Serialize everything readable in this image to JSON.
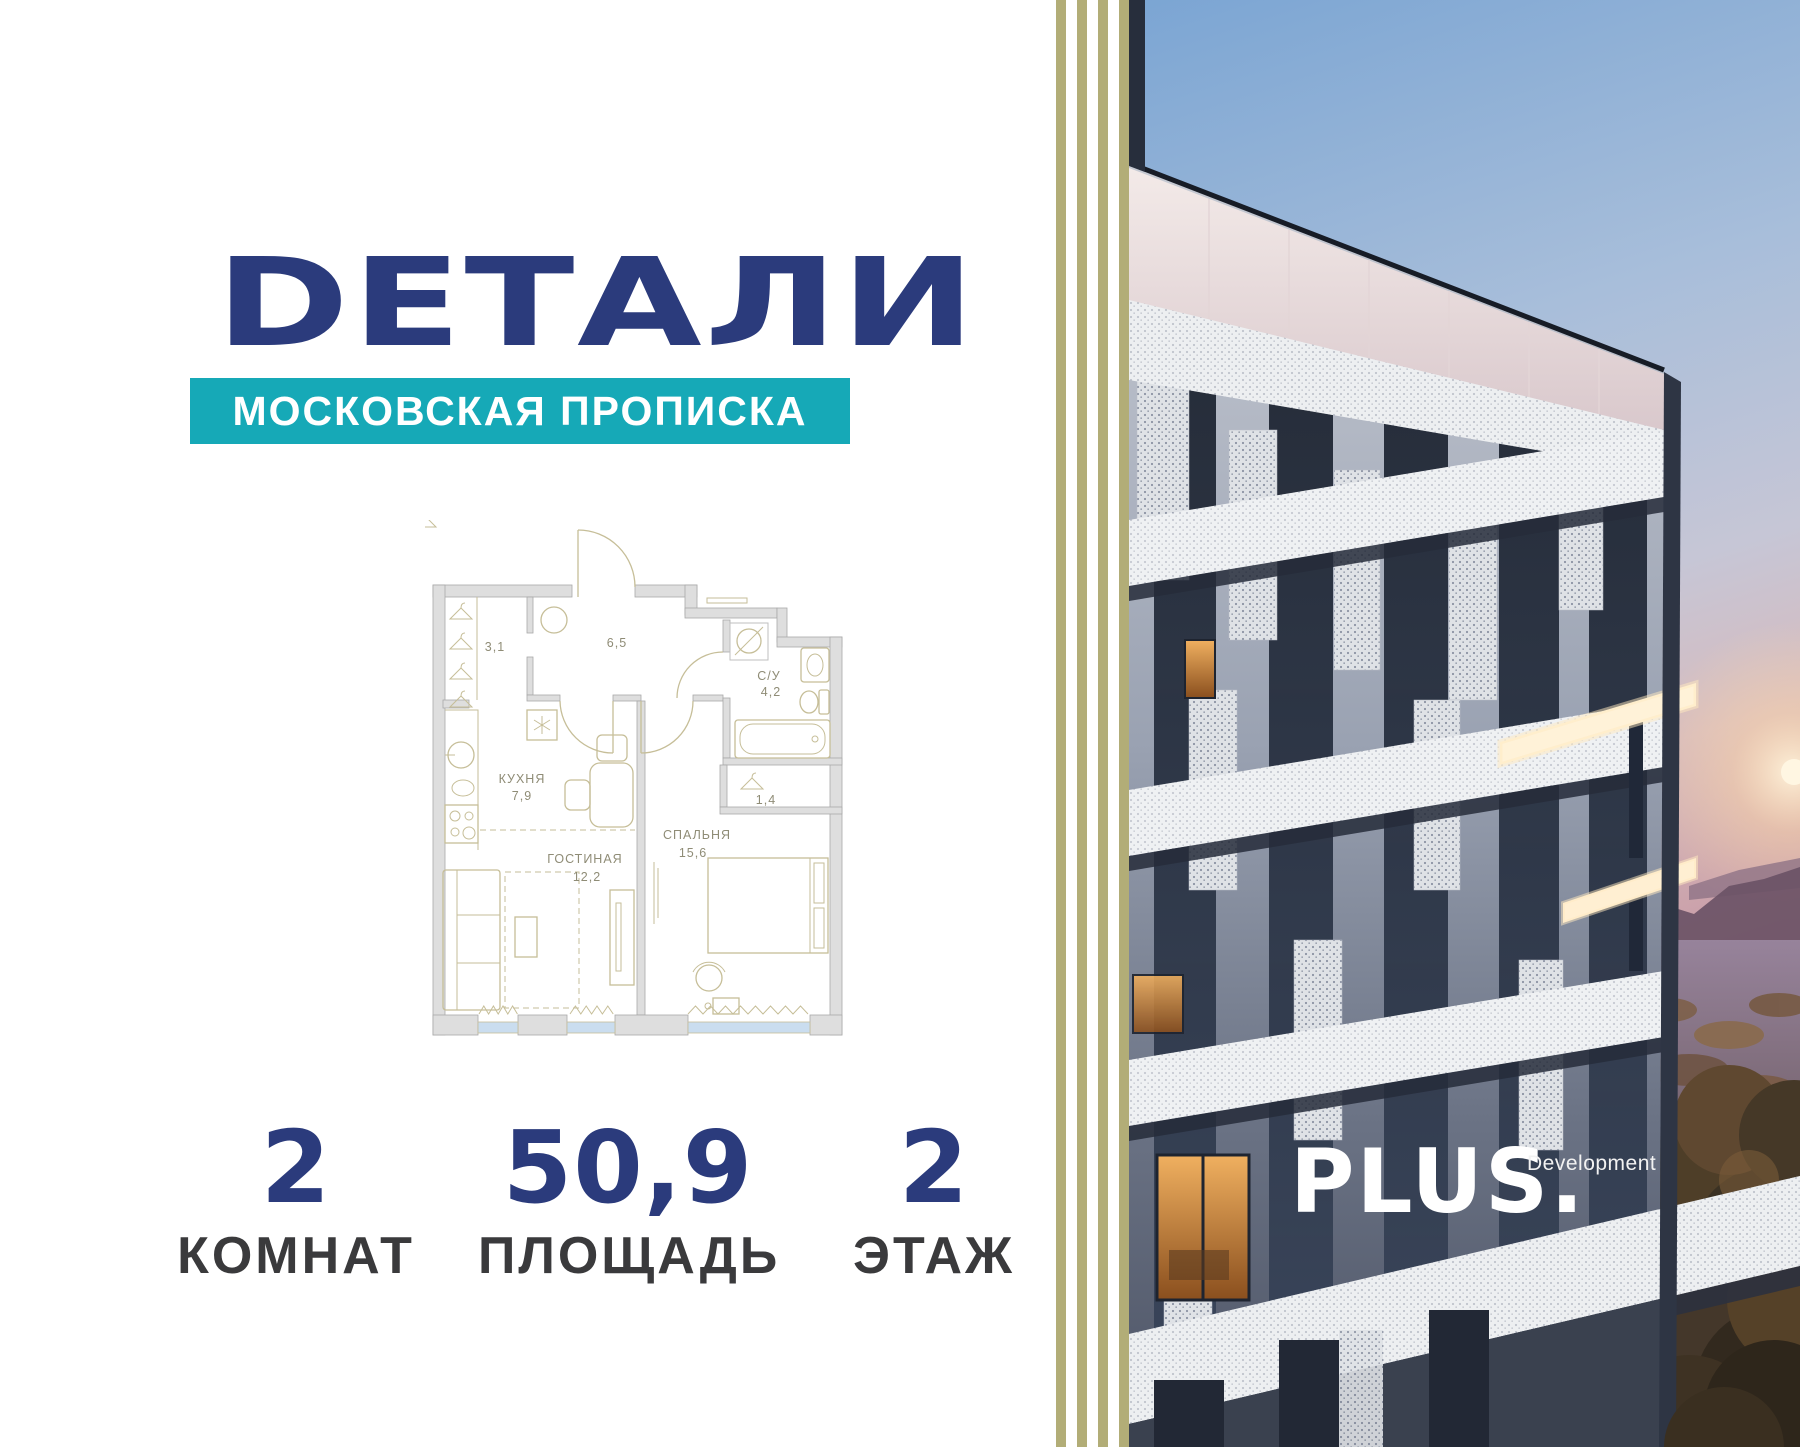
{
  "brand": {
    "logo": "DЕТАЛИ",
    "tagline": "МОСКОВСКАЯ ПРОПИСКА"
  },
  "developer": {
    "name": "PLUS.",
    "descriptor": "Development"
  },
  "floor_plan": {
    "rooms": [
      {
        "name": "",
        "area": "3,1"
      },
      {
        "name": "",
        "area": "6,5"
      },
      {
        "name": "С/У",
        "area": "4,2"
      },
      {
        "name": "КУХНЯ",
        "area": "7,9"
      },
      {
        "name": "",
        "area": "1,4"
      },
      {
        "name": "ГОСТИНАЯ",
        "area": "12,2"
      },
      {
        "name": "СПАЛЬНЯ",
        "area": "15,6"
      }
    ]
  },
  "stats": [
    {
      "value": "2",
      "label": "КОМНАТ"
    },
    {
      "value": "50,9",
      "label": "ПЛОЩАДЬ"
    },
    {
      "value": "2",
      "label": "ЭТАЖ"
    }
  ],
  "colors": {
    "navy": "#2B3B7C",
    "teal": "#16A9B7",
    "stripe_olive": "#B2AD77",
    "plan_line": "#C6BE98",
    "plan_wall": "#DEDEDE",
    "window_glass": "#CADDEF",
    "label_gray": "#3A3A3C"
  }
}
